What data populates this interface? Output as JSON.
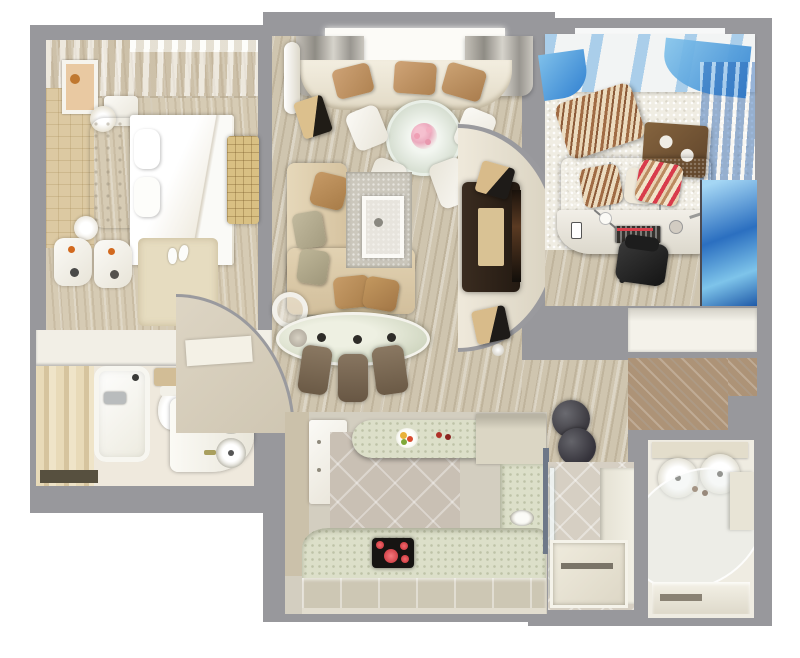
{
  "meta": {
    "title": "Apartment 3D floor plan — top-down render",
    "view": "top-down orthographic 3D visualization",
    "has_text": false
  },
  "palette": {
    "background": "#ffffff",
    "wall_gray": "#98989c",
    "wood_floor": "#cfc5af",
    "cream_wall": "#efe9dc",
    "beige_tile": "#dcc9a2",
    "sofa_beige": "#dcc9a8",
    "pillow_tan": "#bd9364",
    "kids_blue": "#4a8ed0",
    "denim_sofa": "#6d8fa4",
    "counter_celadon": "#dcdfc9",
    "cooktop_black": "#161412",
    "burner_red": "#e8474b",
    "tv_cabinet_brown": "#30241b",
    "deck_wood": "#ad9377"
  },
  "rooms": {
    "bedroom": {
      "name": "Bedroom",
      "furniture": [
        "double bed with white duvet",
        "tufted headboard",
        "nightstand",
        "table lamp",
        "wall picture",
        "sheer window curtains",
        "beige tiled wall panel",
        "quilted tan bench",
        "two cream armchairs",
        "side table with lamp",
        "beige rug",
        "slippers"
      ]
    },
    "living": {
      "name": "Living room",
      "furniture": [
        "bay window with gray curtains",
        "curved window seat with tan pillows",
        "round glass dining table with flowers",
        "four white chairs",
        "beige corner sofa",
        "gray area rug",
        "white coffee table",
        "floor lamp",
        "oval glass bar counter",
        "three brown bar stools",
        "curved TV wall",
        "dark TV cabinet",
        "tan speakers"
      ]
    },
    "kids": {
      "name": "Kids room / office",
      "furniture": [
        "blue denim sofa",
        "striped pillows",
        "striped pouf",
        "wooden wall shelf",
        "white curved desk",
        "keyboard",
        "desk phone",
        "black office chair",
        "blue gradient curtain",
        "white shag rug",
        "blue mural wardrobe"
      ]
    },
    "kitchen": {
      "name": "Kitchen",
      "furniture": [
        "U-shaped celadon counter",
        "breakfast bar with fruit bowl",
        "tall cabinet",
        "induction cooktop with red burners",
        "sink",
        "diagonal tile floor",
        "base cabinets"
      ]
    },
    "bathroom": {
      "name": "Bathroom",
      "furniture": [
        "bathtub",
        "toilet",
        "double round-sink vanity",
        "striped tile wall",
        "dark shelf"
      ]
    },
    "shower": {
      "name": "Shower room",
      "furniture": [
        "shower tray",
        "glass partition",
        "diagonal tile floor"
      ]
    },
    "ensuite": {
      "name": "En-suite shower room",
      "furniture": [
        "twin round sinks",
        "curved glass shower screen",
        "bench step"
      ]
    },
    "hallway": {
      "name": "Hallway",
      "furniture": [
        "curved entry wall",
        "wood floor",
        "two dark cylinder stools",
        "built-in wardrobe",
        "doormat"
      ]
    },
    "balcony": {
      "name": "Balcony / loggia",
      "furniture": [
        "wood decking"
      ]
    }
  }
}
